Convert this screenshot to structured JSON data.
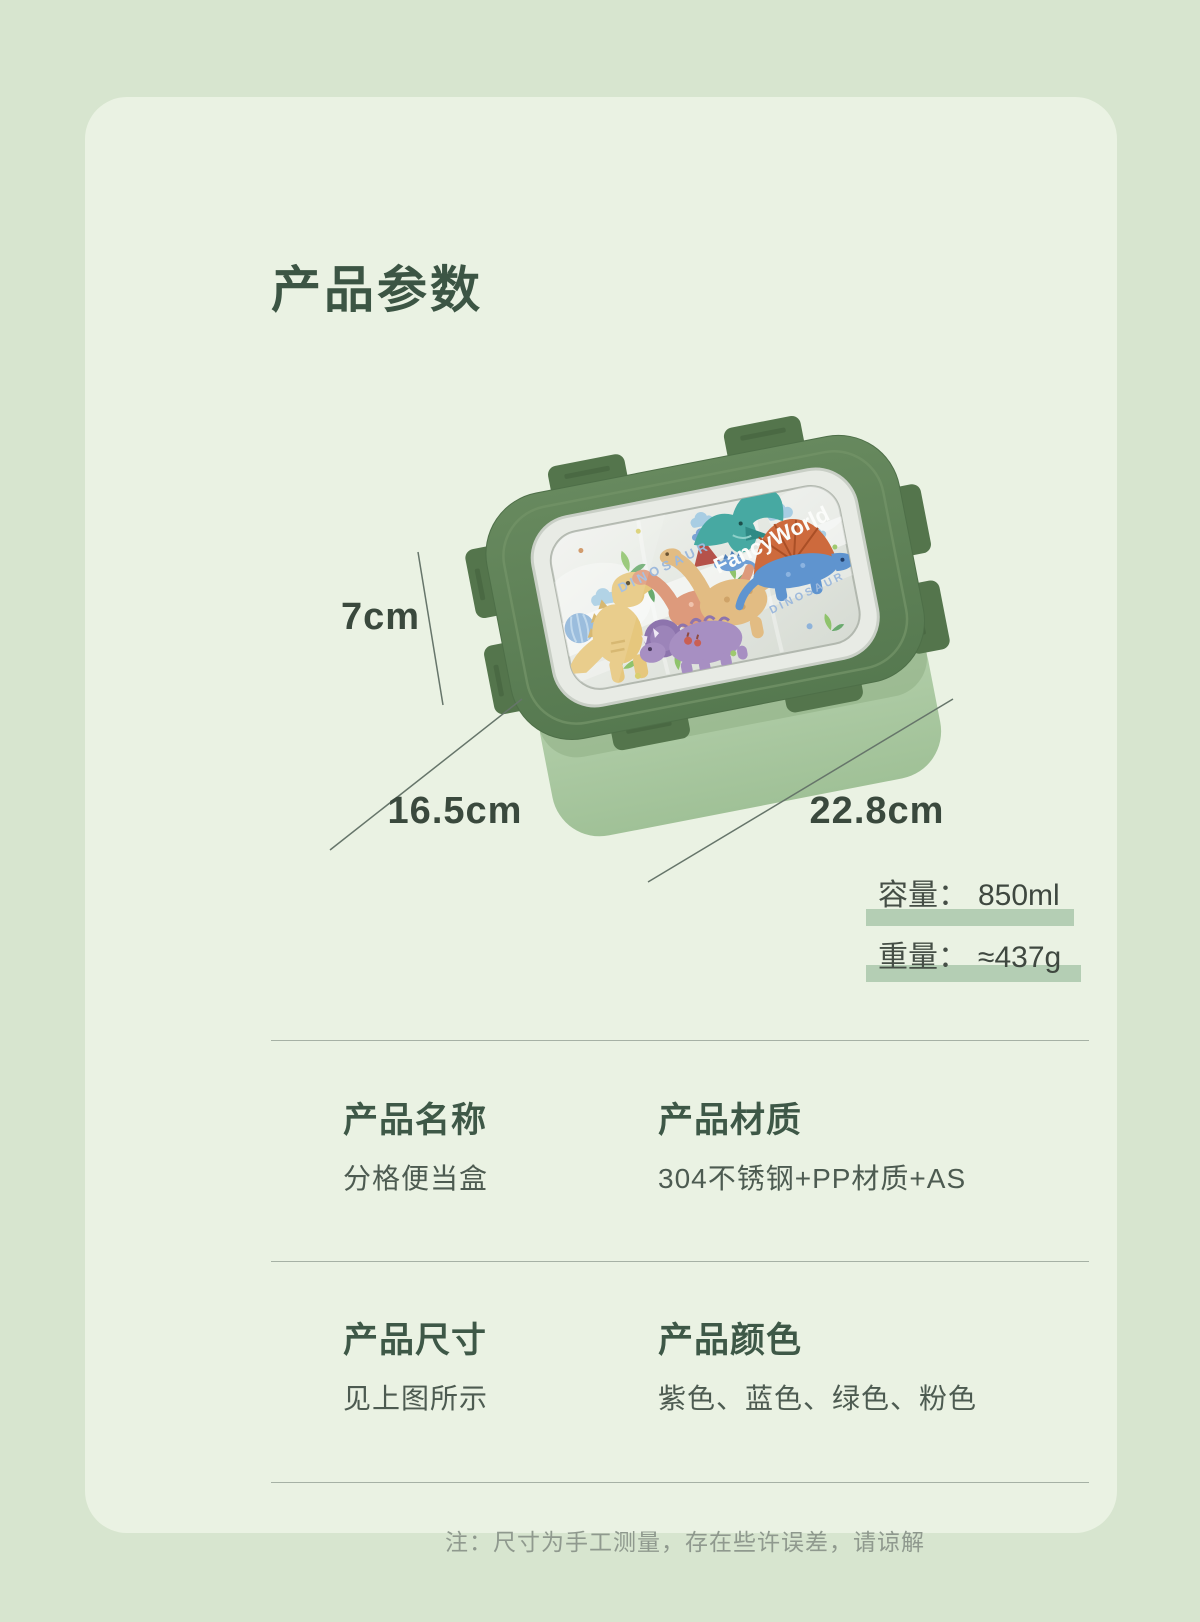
{
  "page": {
    "title": "产品参数",
    "note": "注：尺寸为手工测量，存在些许误差，请谅解"
  },
  "illustration": {
    "brand_text": "FancyWorld",
    "lid_text_left": "DINOSAUR",
    "lid_text_right": "DINOSAUR",
    "dim_height": "7cm",
    "dim_depth": "16.5cm",
    "dim_width": "22.8cm"
  },
  "metrics": [
    {
      "label": "容量：",
      "value": "850ml"
    },
    {
      "label": "重量：",
      "value": "≈437g"
    }
  ],
  "specs": [
    {
      "heading": "产品名称",
      "value": "分格便当盒"
    },
    {
      "heading": "产品材质",
      "value": "304不锈钢+PP材质+AS"
    },
    {
      "heading": "产品尺寸",
      "value": "见上图所示"
    },
    {
      "heading": "产品颜色",
      "value": "紫色、蓝色、绿色、粉色"
    }
  ],
  "colors": {
    "page_bg": "#d7e5cf",
    "card_bg": "#eaf2e3",
    "accent_dark_green": "#3e5847",
    "highlight_bar": "#b4ceb4",
    "lid_green": "#5e7f55",
    "base_green": "#b9d3b0"
  }
}
